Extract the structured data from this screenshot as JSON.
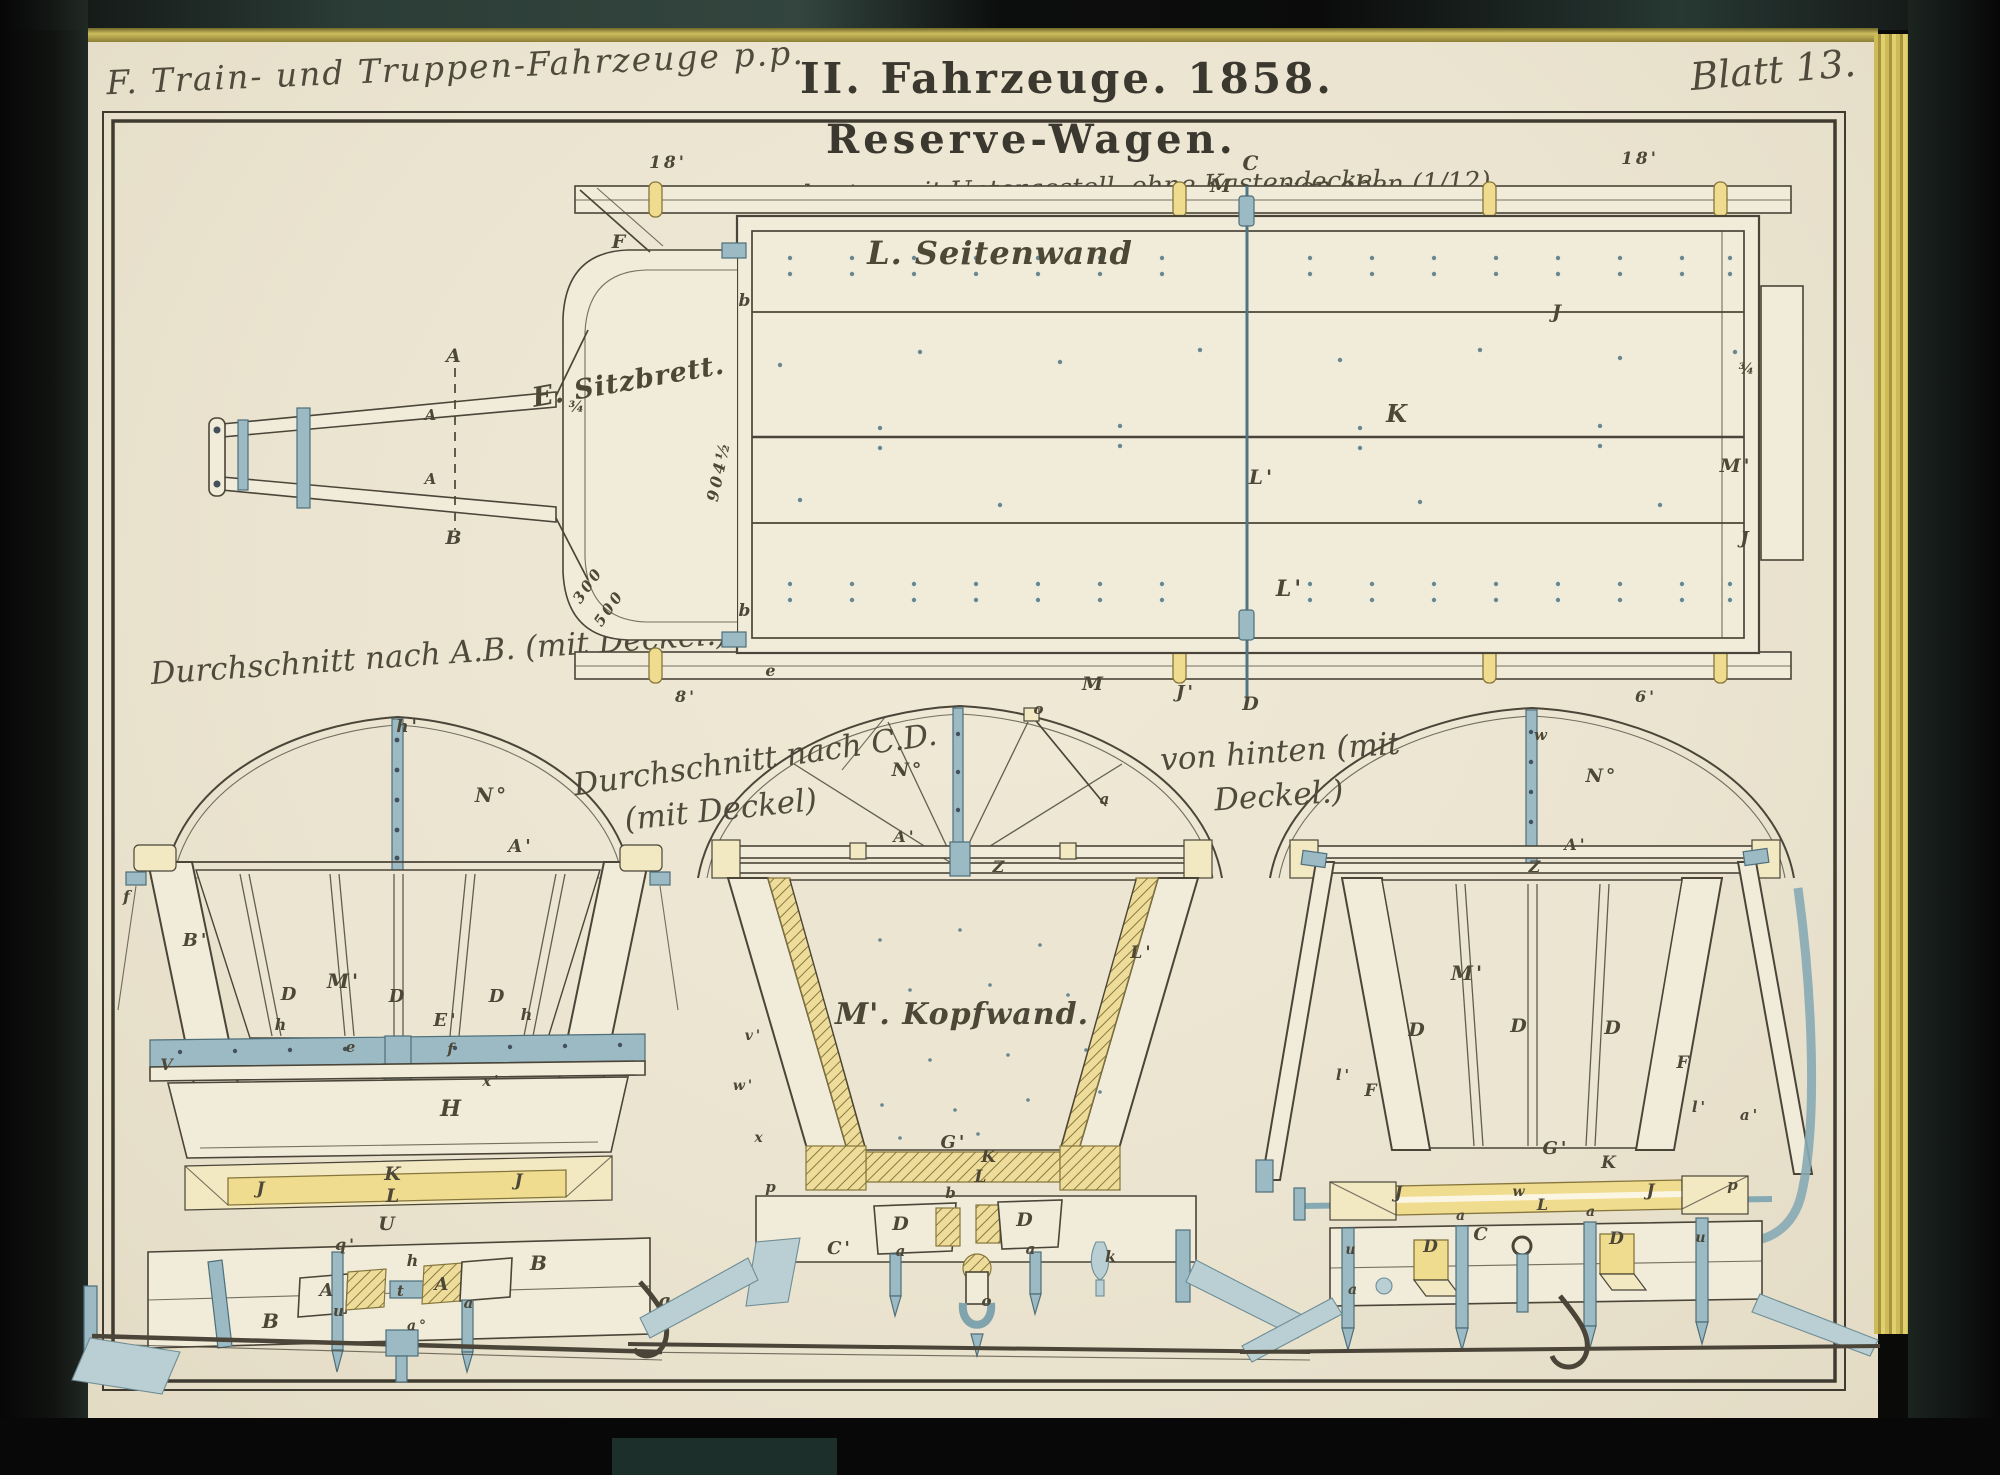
{
  "page": {
    "series_title": "F. Train- und Truppen-Fahrzeuge p.p.",
    "plate_title": "II. Fahrzeuge. 1858.",
    "sheet_label": "Blatt 13.",
    "subject_title": "Reserve-Wagen."
  },
  "captions": {
    "top_view_left": "Wagenkasten mit Untergestell, ohne Kastendeckel.",
    "top_view_right": "von oben (1/12)",
    "section_ab": "Durchschnitt nach A.B. (mit Deckel.)",
    "section_cd_line1": "Durchschnitt nach C.D.",
    "section_cd_line2": "(mit Deckel)",
    "rear_line1": "von hinten (mit",
    "rear_line2": "Deckel.)"
  },
  "colors": {
    "paper": "#ebe4d0",
    "ink": "#4a4538",
    "steel_blue": "#9cbac3",
    "wood_yellow": "#f0dc8e",
    "pale_yellow": "#f2e8c2",
    "gilt_edge": "#cdbb58",
    "cover_dark": "#2c3d37",
    "surround": "#0a0a09",
    "nail_dot": "#4f7585"
  },
  "labels": {
    "top_view": [
      {
        "t": "18'",
        "x": 668,
        "y": 168,
        "s": 17
      },
      {
        "t": "18'",
        "x": 1640,
        "y": 164,
        "s": 17
      },
      {
        "t": "C",
        "x": 1252,
        "y": 170,
        "s": 20
      },
      {
        "t": "M",
        "x": 1222,
        "y": 192,
        "s": 19
      },
      {
        "t": "F",
        "x": 620,
        "y": 248,
        "s": 19
      },
      {
        "t": "L. Seitenwand",
        "x": 1000,
        "y": 264,
        "s": 32,
        "c": "script"
      },
      {
        "t": "E. Sitzbrett.",
        "x": 630,
        "y": 390,
        "s": 27,
        "c": "script",
        "r": -10
      },
      {
        "t": "b",
        "x": 746,
        "y": 306,
        "s": 17
      },
      {
        "t": "b",
        "x": 746,
        "y": 616,
        "s": 17
      },
      {
        "t": "904½",
        "x": 724,
        "y": 472,
        "s": 16,
        "r": -78
      },
      {
        "t": "300",
        "x": 592,
        "y": 588,
        "s": 15,
        "r": -55
      },
      {
        "t": "500",
        "x": 613,
        "y": 611,
        "s": 15,
        "r": -55
      },
      {
        "t": "J",
        "x": 1558,
        "y": 318,
        "s": 19
      },
      {
        "t": "K",
        "x": 1398,
        "y": 422,
        "s": 24
      },
      {
        "t": "L'",
        "x": 1262,
        "y": 484,
        "s": 20
      },
      {
        "t": "L'",
        "x": 1290,
        "y": 596,
        "s": 22
      },
      {
        "t": "M'",
        "x": 1736,
        "y": 472,
        "s": 19
      },
      {
        "t": "M",
        "x": 1094,
        "y": 690,
        "s": 19
      },
      {
        "t": "J'",
        "x": 1186,
        "y": 698,
        "s": 18
      },
      {
        "t": "D",
        "x": 1252,
        "y": 710,
        "s": 19
      },
      {
        "t": "J",
        "x": 1746,
        "y": 544,
        "s": 18
      },
      {
        "t": "e",
        "x": 772,
        "y": 676,
        "s": 16
      },
      {
        "t": "A",
        "x": 455,
        "y": 362,
        "s": 19
      },
      {
        "t": "B",
        "x": 455,
        "y": 544,
        "s": 19
      },
      {
        "t": "A",
        "x": 432,
        "y": 420,
        "s": 15
      },
      {
        "t": "A",
        "x": 432,
        "y": 484,
        "s": 15
      },
      {
        "t": "8'",
        "x": 686,
        "y": 702,
        "s": 16
      },
      {
        "t": "6'",
        "x": 1646,
        "y": 702,
        "s": 16
      },
      {
        "t": "¾",
        "x": 1748,
        "y": 374,
        "s": 15
      },
      {
        "t": "¾",
        "x": 578,
        "y": 412,
        "s": 15
      }
    ],
    "section_ab": [
      {
        "t": "h'",
        "x": 408,
        "y": 732,
        "s": 17
      },
      {
        "t": "N°",
        "x": 492,
        "y": 802,
        "s": 20
      },
      {
        "t": "A'",
        "x": 521,
        "y": 852,
        "s": 18
      },
      {
        "t": "f",
        "x": 128,
        "y": 902,
        "s": 16
      },
      {
        "t": "B'",
        "x": 196,
        "y": 946,
        "s": 18
      },
      {
        "t": "D",
        "x": 290,
        "y": 1000,
        "s": 18
      },
      {
        "t": "M'",
        "x": 344,
        "y": 988,
        "s": 20
      },
      {
        "t": "D",
        "x": 398,
        "y": 1002,
        "s": 18
      },
      {
        "t": "D",
        "x": 498,
        "y": 1002,
        "s": 18
      },
      {
        "t": "E'",
        "x": 446,
        "y": 1026,
        "s": 18
      },
      {
        "t": "h",
        "x": 282,
        "y": 1030,
        "s": 16
      },
      {
        "t": "h",
        "x": 528,
        "y": 1020,
        "s": 16
      },
      {
        "t": "e",
        "x": 352,
        "y": 1052,
        "s": 15
      },
      {
        "t": "f",
        "x": 452,
        "y": 1054,
        "s": 15
      },
      {
        "t": "x'",
        "x": 492,
        "y": 1086,
        "s": 15
      },
      {
        "t": "V",
        "x": 168,
        "y": 1070,
        "s": 16
      },
      {
        "t": "H",
        "x": 452,
        "y": 1116,
        "s": 22
      },
      {
        "t": "K",
        "x": 394,
        "y": 1180,
        "s": 19
      },
      {
        "t": "L",
        "x": 394,
        "y": 1202,
        "s": 19
      },
      {
        "t": "U",
        "x": 388,
        "y": 1230,
        "s": 19
      },
      {
        "t": "J",
        "x": 262,
        "y": 1194,
        "s": 17
      },
      {
        "t": "J",
        "x": 520,
        "y": 1186,
        "s": 17
      },
      {
        "t": "q'",
        "x": 346,
        "y": 1250,
        "s": 16
      },
      {
        "t": "h",
        "x": 414,
        "y": 1266,
        "s": 16
      },
      {
        "t": "A",
        "x": 328,
        "y": 1296,
        "s": 18
      },
      {
        "t": "A",
        "x": 443,
        "y": 1290,
        "s": 18
      },
      {
        "t": "B",
        "x": 272,
        "y": 1328,
        "s": 20
      },
      {
        "t": "B",
        "x": 540,
        "y": 1270,
        "s": 20
      },
      {
        "t": "t",
        "x": 402,
        "y": 1296,
        "s": 15
      },
      {
        "t": "a",
        "x": 470,
        "y": 1308,
        "s": 15
      },
      {
        "t": "u",
        "x": 340,
        "y": 1316,
        "s": 15
      },
      {
        "t": "a°",
        "x": 418,
        "y": 1330,
        "s": 14
      },
      {
        "t": "g",
        "x": 666,
        "y": 1306,
        "s": 17
      }
    ],
    "section_cd": [
      {
        "t": "o",
        "x": 1040,
        "y": 714,
        "s": 15
      },
      {
        "t": "N°",
        "x": 908,
        "y": 776,
        "s": 19
      },
      {
        "t": "a",
        "x": 1106,
        "y": 804,
        "s": 15
      },
      {
        "t": "A'",
        "x": 905,
        "y": 842,
        "s": 16
      },
      {
        "t": "Z",
        "x": 1000,
        "y": 872,
        "s": 16
      },
      {
        "t": "v'",
        "x": 754,
        "y": 1040,
        "s": 14
      },
      {
        "t": "w'",
        "x": 744,
        "y": 1090,
        "s": 14
      },
      {
        "t": "x",
        "x": 760,
        "y": 1142,
        "s": 14
      },
      {
        "t": "L'",
        "x": 1142,
        "y": 958,
        "s": 17
      },
      {
        "t": "M'. Kopfwand.",
        "x": 962,
        "y": 1024,
        "s": 30,
        "c": "script"
      },
      {
        "t": "G'",
        "x": 954,
        "y": 1148,
        "s": 18
      },
      {
        "t": "K",
        "x": 990,
        "y": 1162,
        "s": 17
      },
      {
        "t": "L",
        "x": 982,
        "y": 1182,
        "s": 17
      },
      {
        "t": "b",
        "x": 952,
        "y": 1198,
        "s": 15
      },
      {
        "t": "p",
        "x": 772,
        "y": 1192,
        "s": 15
      },
      {
        "t": "D",
        "x": 902,
        "y": 1230,
        "s": 19
      },
      {
        "t": "D",
        "x": 1026,
        "y": 1226,
        "s": 19
      },
      {
        "t": "C'",
        "x": 840,
        "y": 1254,
        "s": 18
      },
      {
        "t": "a",
        "x": 902,
        "y": 1256,
        "s": 15
      },
      {
        "t": "a",
        "x": 1032,
        "y": 1254,
        "s": 15
      },
      {
        "t": "k",
        "x": 1112,
        "y": 1262,
        "s": 16
      },
      {
        "t": "o",
        "x": 988,
        "y": 1306,
        "s": 15
      }
    ],
    "rear_view": [
      {
        "t": "w",
        "x": 1542,
        "y": 740,
        "s": 15
      },
      {
        "t": "N°",
        "x": 1602,
        "y": 782,
        "s": 19
      },
      {
        "t": "A'",
        "x": 1576,
        "y": 850,
        "s": 16
      },
      {
        "t": "Z",
        "x": 1536,
        "y": 872,
        "s": 16
      },
      {
        "t": "M'",
        "x": 1468,
        "y": 980,
        "s": 20
      },
      {
        "t": "D",
        "x": 1418,
        "y": 1036,
        "s": 19
      },
      {
        "t": "D",
        "x": 1520,
        "y": 1032,
        "s": 19
      },
      {
        "t": "D",
        "x": 1614,
        "y": 1034,
        "s": 19
      },
      {
        "t": "F",
        "x": 1372,
        "y": 1096,
        "s": 17
      },
      {
        "t": "F",
        "x": 1684,
        "y": 1068,
        "s": 17
      },
      {
        "t": "l'",
        "x": 1344,
        "y": 1080,
        "s": 15
      },
      {
        "t": "l'",
        "x": 1700,
        "y": 1112,
        "s": 15
      },
      {
        "t": "a'",
        "x": 1750,
        "y": 1120,
        "s": 15
      },
      {
        "t": "G'",
        "x": 1556,
        "y": 1154,
        "s": 18
      },
      {
        "t": "K",
        "x": 1610,
        "y": 1168,
        "s": 17
      },
      {
        "t": "J",
        "x": 1400,
        "y": 1198,
        "s": 17
      },
      {
        "t": "J",
        "x": 1652,
        "y": 1196,
        "s": 17
      },
      {
        "t": "w",
        "x": 1520,
        "y": 1196,
        "s": 14
      },
      {
        "t": "L",
        "x": 1544,
        "y": 1210,
        "s": 16
      },
      {
        "t": "C",
        "x": 1482,
        "y": 1240,
        "s": 18
      },
      {
        "t": "a",
        "x": 1462,
        "y": 1220,
        "s": 14
      },
      {
        "t": "a",
        "x": 1592,
        "y": 1216,
        "s": 14
      },
      {
        "t": "D",
        "x": 1432,
        "y": 1252,
        "s": 17
      },
      {
        "t": "D",
        "x": 1618,
        "y": 1244,
        "s": 17
      },
      {
        "t": "u",
        "x": 1352,
        "y": 1254,
        "s": 14
      },
      {
        "t": "a",
        "x": 1354,
        "y": 1294,
        "s": 14
      },
      {
        "t": "p",
        "x": 1734,
        "y": 1190,
        "s": 15
      },
      {
        "t": "u",
        "x": 1702,
        "y": 1242,
        "s": 14
      }
    ]
  }
}
